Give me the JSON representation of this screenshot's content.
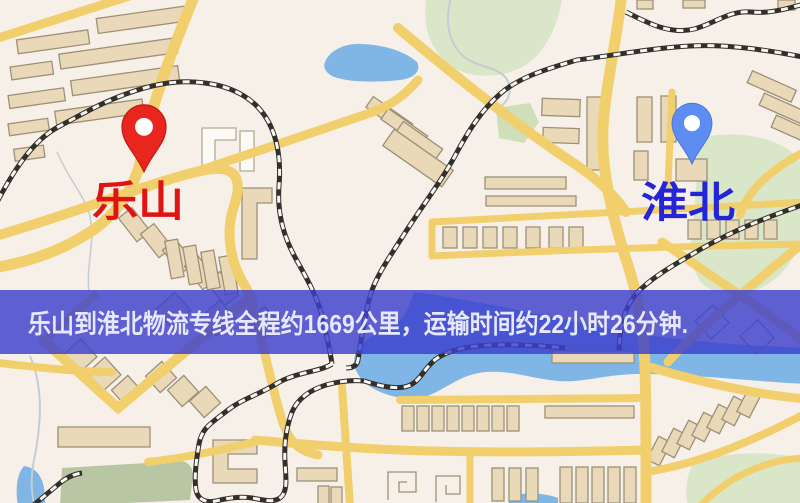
{
  "map": {
    "origin": {
      "name": "乐山",
      "label_color": "#e01212",
      "pin_color": "#e8261d",
      "pin_edge": "#c01410",
      "pin_hole_color": "#ffffff"
    },
    "destination": {
      "name": "淮北",
      "label_color": "#2424d8",
      "pin_color": "#5d8df3",
      "pin_edge": "#4a74d6",
      "pin_hole_color": "#ffffff"
    },
    "banner": {
      "text": "乐山到淮北物流专线全程约1669公里，运输时间约22小时26分钟.",
      "distance_km": "1669",
      "duration_hours": "22",
      "duration_minutes": "26",
      "bg_color": "rgba(60,63,205,0.82)",
      "text_color": "#e7e8fb"
    }
  },
  "colors": {
    "background": "#f7f0e9",
    "road": "#f2cf6d",
    "road_white": "#fdfcf6",
    "water": "#7fb6e6",
    "park": "#d9e6c8",
    "park_dark": "#b9c6a4",
    "building": "#ead9b8",
    "building_outline": "#9d9077",
    "building_white": "#fbfaf5",
    "railway": "#332f2b",
    "railway_dash": "#f8f7f2",
    "stream": "#c3cdd2"
  }
}
